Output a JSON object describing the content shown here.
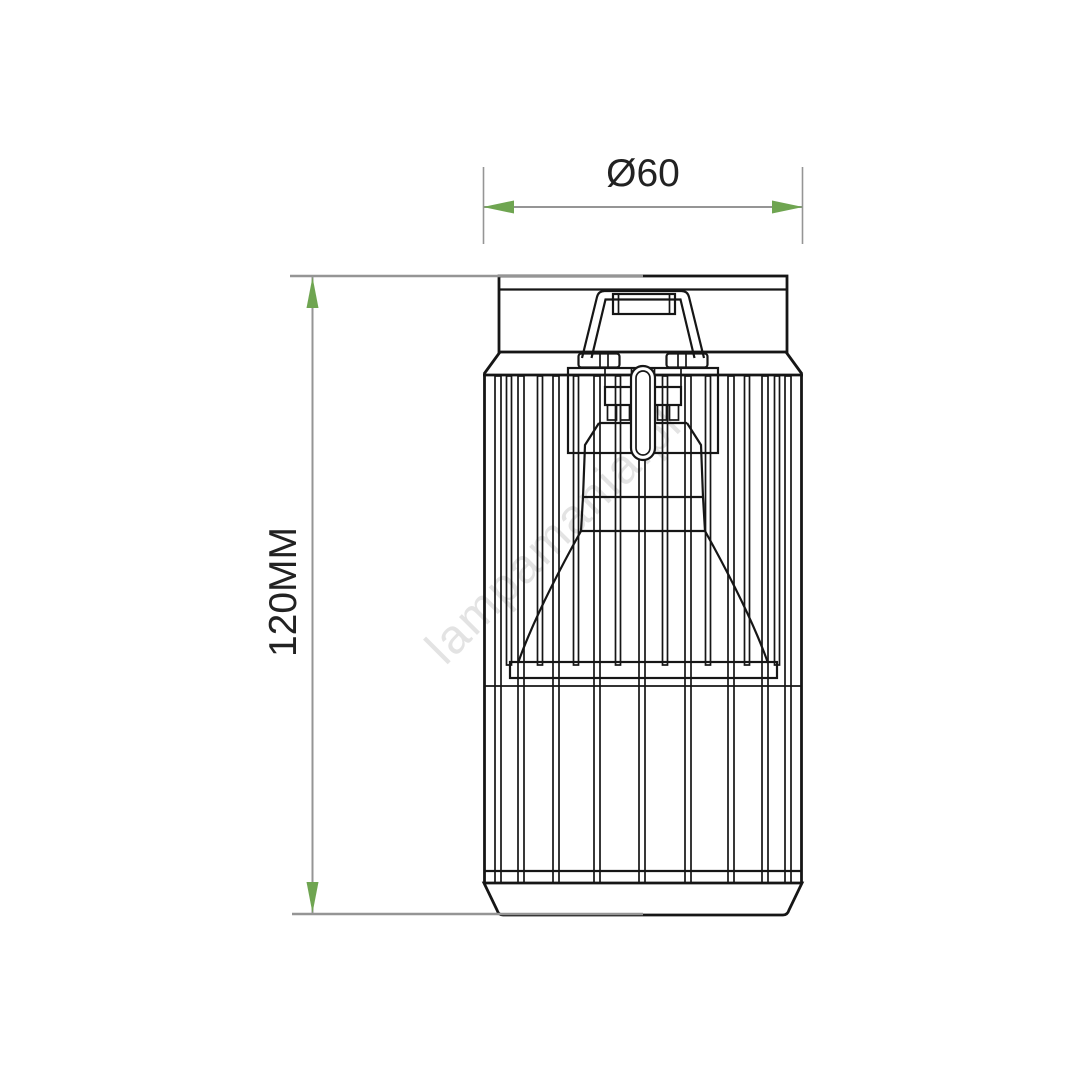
{
  "diagram": {
    "type": "technical-drawing",
    "dimensions": {
      "width": {
        "label": "Ø60"
      },
      "height": {
        "label": "120MM"
      }
    },
    "watermark": {
      "text": "lampamania.pl"
    },
    "colors": {
      "line": "#161616",
      "dimension_line": "#959595",
      "arrow_green": "#6fa551",
      "dim_text": "#222222",
      "watermark_gray": "#e3e3e3"
    }
  }
}
